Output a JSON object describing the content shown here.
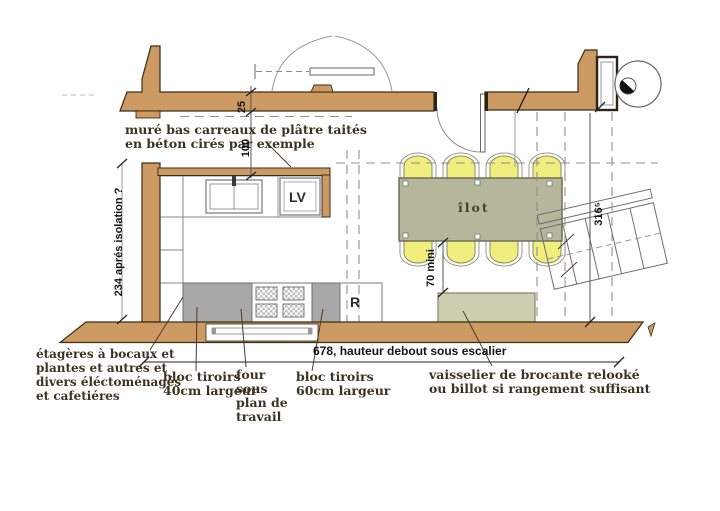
{
  "colors": {
    "wall": "#cd9a63",
    "wall_outline": "#3a2d15",
    "island": "#b6b79a",
    "stool": "#f0ee7c",
    "dresser": "#cbcfae",
    "cabinet_gray": "#a8a8a8",
    "ink": "#3c3220"
  },
  "note_mur": {
    "l1": "muré bas carreaux de plâtre taités",
    "l2": "en béton cirés par exemple"
  },
  "dims": {
    "left": "234 aprés isolation ?",
    "d25": "25",
    "d100": "100",
    "d70": "70 mini",
    "d316": "316⁵",
    "d678": "678, hauteur debout sous escalier"
  },
  "units": {
    "dishwasher": "LV",
    "fridge": "R",
    "island": "îlot"
  },
  "legend": {
    "etageres": [
      "étagères à bocaux et",
      "plantes et autres et",
      "divers éléctoménagés",
      "et cafetiéres"
    ],
    "bloc40": [
      "bloc tiroirs",
      "40cm largeur"
    ],
    "four": [
      "four",
      "sous",
      "plan de",
      "travail"
    ],
    "bloc60": [
      "bloc tiroirs",
      "60cm largeur"
    ],
    "vaisselier": [
      "vaisselier de brocante relooké",
      "ou  billot si rangement suffisant"
    ]
  }
}
